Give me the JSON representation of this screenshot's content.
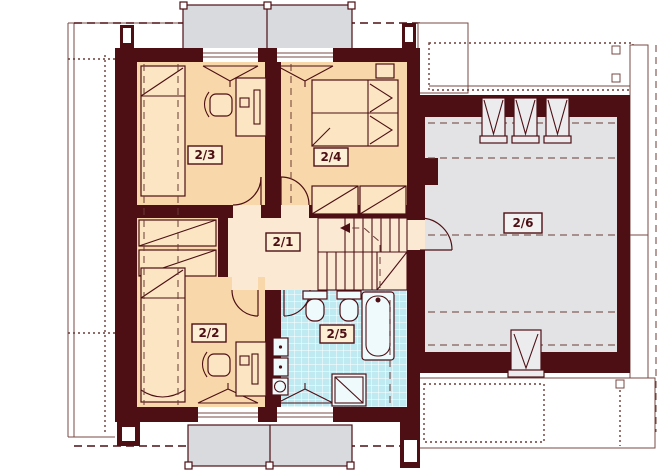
{
  "plan": {
    "rooms": [
      {
        "label": "2/1"
      },
      {
        "label": "2/2"
      },
      {
        "label": "2/3"
      },
      {
        "label": "2/4"
      },
      {
        "label": "2/5"
      },
      {
        "label": "2/6"
      }
    ],
    "colors": {
      "wall": "#4d0f14",
      "bedroom": "#f8d8ab",
      "hall": "#fbe9d4",
      "bathroom_tiles": "#bfeaf2",
      "attic_room": "#e3e3e5",
      "dormer_roof": "#d9dadd",
      "background": "#ffffff"
    }
  }
}
